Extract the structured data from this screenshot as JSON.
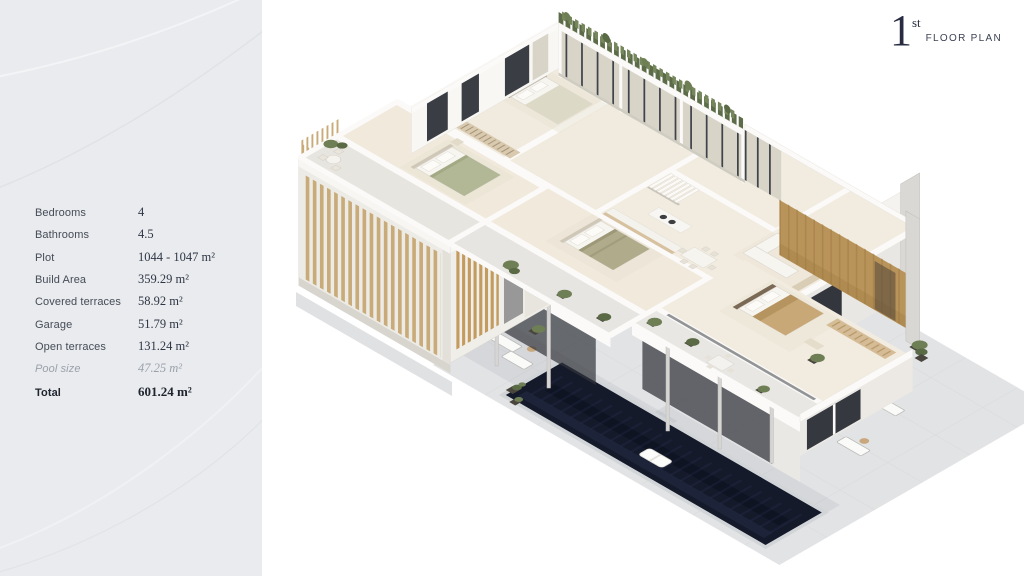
{
  "header": {
    "floor_number": "1",
    "floor_suffix": "st",
    "label": "FLOOR PLAN"
  },
  "sidebar": {
    "background": "#e9ebee",
    "specs": [
      {
        "label": "Bedrooms",
        "value": "4"
      },
      {
        "label": "Bathrooms",
        "value": "4.5"
      },
      {
        "label": "Plot",
        "value": "1044 - 1047 m²"
      },
      {
        "label": "Build Area",
        "value": "359.29 m²"
      },
      {
        "label": "Covered terraces",
        "value": "58.92 m²"
      },
      {
        "label": "Garage",
        "value": "51.79 m²"
      },
      {
        "label": "Open terraces",
        "value": "131.24 m²"
      },
      {
        "label": "Pool size",
        "value": "47.25 m²"
      },
      {
        "label": "Total",
        "value": "601.24 m²"
      }
    ]
  },
  "plan": {
    "colors": {
      "pool_water": "#151a2b",
      "wood_slats": "#c9aa79",
      "wood_wall": "#b8935a",
      "greenery": "#6f7f55",
      "terrace": "#e2e3e5",
      "interior_floor": "#f1ebdf",
      "walls": "#fbfaf8",
      "title_text": "#272c41"
    }
  }
}
